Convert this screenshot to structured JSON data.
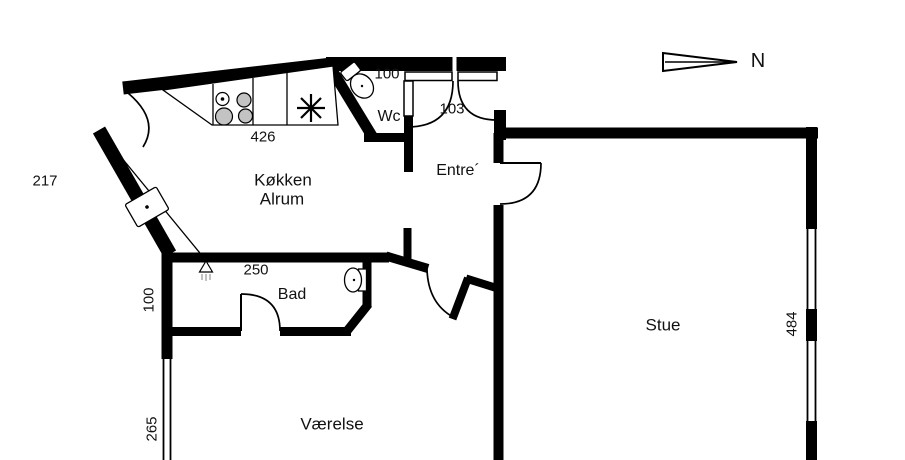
{
  "rooms": {
    "kitchen_line1": "Køkken",
    "kitchen_line2": "Alrum",
    "wc": "Wc",
    "entre": "Entre´",
    "bad": "Bad",
    "vaerelse": "Værelse",
    "stue": "Stue"
  },
  "dims": {
    "kitchen_counter": "426",
    "wc_width": "100",
    "entrance_door": "103",
    "left_upper": "217",
    "bad_width": "250",
    "left_wall": "100",
    "left_window": "265",
    "right_window": "484"
  },
  "compass": {
    "north_label": "N"
  },
  "colors": {
    "wall": "#000000",
    "burner_fill": "#c3c3c3",
    "shower_hatch": "#9a9a9a",
    "background": "#ffffff"
  }
}
